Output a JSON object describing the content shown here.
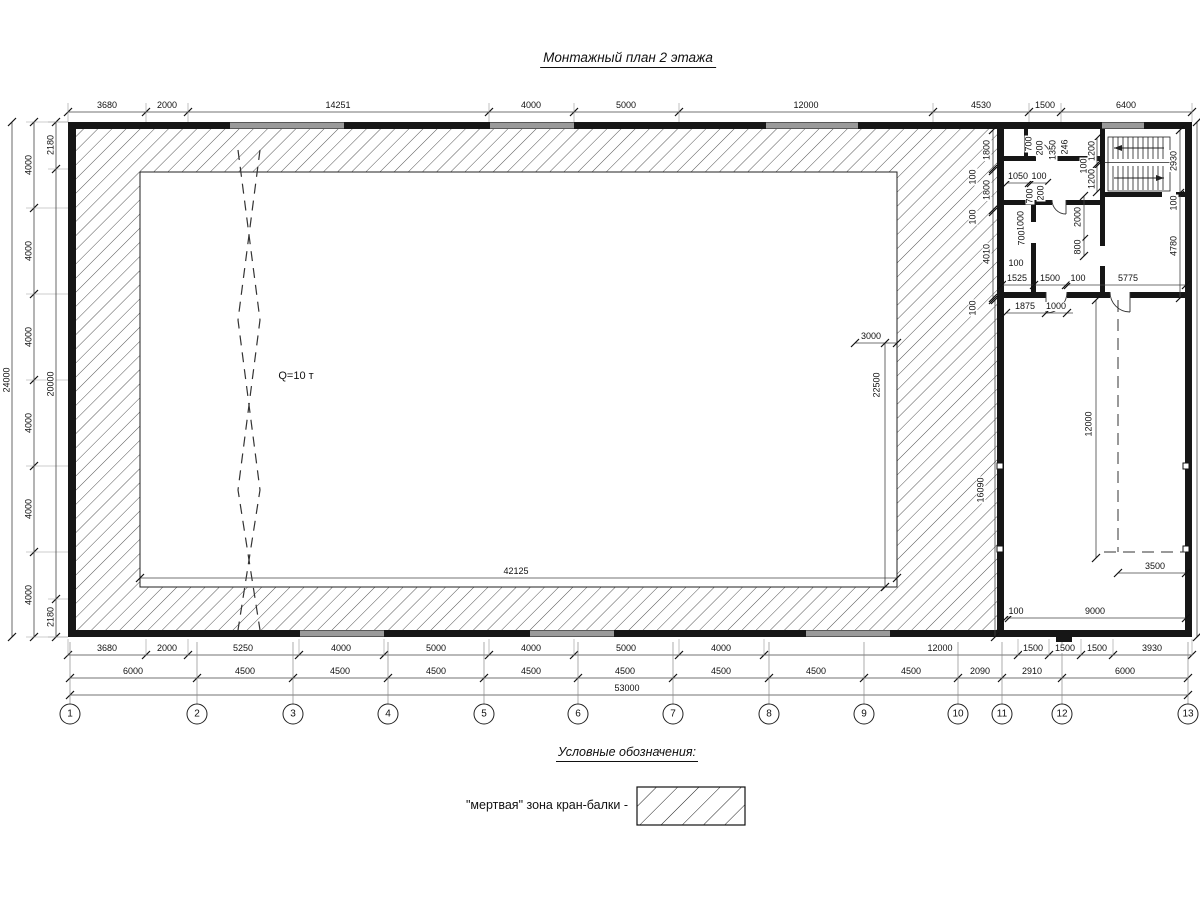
{
  "title": "Монтажный план 2 этажа",
  "crane_label": "Q=10 т",
  "legend": {
    "heading": "Условные обозначения:",
    "item_label": "\"мертвая\" зона кран-балки -"
  },
  "axis_row": {
    "y": 714,
    "items": [
      {
        "n": "1",
        "x": 70
      },
      {
        "n": "2",
        "x": 197
      },
      {
        "n": "3",
        "x": 293
      },
      {
        "n": "4",
        "x": 388
      },
      {
        "n": "5",
        "x": 484
      },
      {
        "n": "6",
        "x": 578
      },
      {
        "n": "7",
        "x": 673
      },
      {
        "n": "8",
        "x": 769
      },
      {
        "n": "9",
        "x": 864
      },
      {
        "n": "10",
        "x": 958
      },
      {
        "n": "11",
        "x": 1002
      },
      {
        "n": "12",
        "x": 1062
      },
      {
        "n": "13",
        "x": 1188
      }
    ]
  },
  "dim_rows": [
    {
      "o": "h",
      "y": 112,
      "x0": 68,
      "x1": 1192,
      "ext": [
        103,
        122
      ],
      "ticks": [
        68,
        146,
        188,
        489,
        574,
        679,
        933,
        1029,
        1061,
        1192
      ],
      "labels": [
        {
          "t": "3680",
          "x": 107
        },
        {
          "t": "2000",
          "x": 167
        },
        {
          "t": "14251",
          "x": 338
        },
        {
          "t": "4000",
          "x": 531
        },
        {
          "t": "5000",
          "x": 626
        },
        {
          "t": "12000",
          "x": 806
        },
        {
          "t": "4530",
          "x": 981
        },
        {
          "t": "1500",
          "x": 1045
        },
        {
          "t": "6400",
          "x": 1126
        }
      ]
    },
    {
      "o": "h",
      "y": 655,
      "x0": 68,
      "x1": 1192,
      "ext": [
        639,
        656
      ],
      "ticks": [
        68,
        146,
        188,
        299,
        384,
        489,
        574,
        679,
        764,
        1018,
        1049,
        1081,
        1113,
        1192
      ],
      "labels": [
        {
          "t": "3680",
          "x": 107
        },
        {
          "t": "2000",
          "x": 167
        },
        {
          "t": "5250",
          "x": 243
        },
        {
          "t": "4000",
          "x": 341
        },
        {
          "t": "5000",
          "x": 436
        },
        {
          "t": "4000",
          "x": 531
        },
        {
          "t": "5000",
          "x": 626
        },
        {
          "t": "4000",
          "x": 721
        },
        {
          "t": "12000",
          "x": 940
        },
        {
          "t": "1500",
          "x": 1033
        },
        {
          "t": "1500",
          "x": 1065
        },
        {
          "t": "1500",
          "x": 1097
        },
        {
          "t": "3930",
          "x": 1152
        }
      ]
    },
    {
      "o": "h",
      "y": 678,
      "x0": 70,
      "x1": 1188,
      "ticks": [
        70,
        197,
        293,
        388,
        484,
        578,
        673,
        769,
        864,
        958,
        1002,
        1062,
        1188
      ],
      "labels": [
        {
          "t": "6000",
          "x": 133
        },
        {
          "t": "4500",
          "x": 245
        },
        {
          "t": "4500",
          "x": 340
        },
        {
          "t": "4500",
          "x": 436
        },
        {
          "t": "4500",
          "x": 531
        },
        {
          "t": "4500",
          "x": 625
        },
        {
          "t": "4500",
          "x": 721
        },
        {
          "t": "4500",
          "x": 816
        },
        {
          "t": "4500",
          "x": 911
        },
        {
          "t": "2090",
          "x": 980
        },
        {
          "t": "2910",
          "x": 1032
        },
        {
          "t": "6000",
          "x": 1125
        }
      ]
    },
    {
      "o": "h",
      "y": 695,
      "x0": 70,
      "x1": 1188,
      "ticks": [
        70,
        1188
      ],
      "labels": [
        {
          "t": "53000",
          "x": 627
        }
      ]
    },
    {
      "o": "h",
      "y": 578,
      "x0": 140,
      "x1": 897,
      "ticks": [
        140,
        897
      ],
      "labels": [
        {
          "t": "42125",
          "x": 516
        }
      ]
    },
    {
      "o": "h",
      "y": 343,
      "x0": 855,
      "x1": 897,
      "ticks": [
        855,
        897
      ],
      "labels": [
        {
          "t": "3000",
          "x": 871
        }
      ]
    },
    {
      "o": "h",
      "y": 285,
      "x0": 1002,
      "x1": 1186,
      "ticks": [
        1002,
        1034,
        1066,
        1068,
        1186
      ],
      "labels": [
        {
          "t": "1525",
          "x": 1017
        },
        {
          "t": "1500",
          "x": 1050
        },
        {
          "t": "100",
          "x": 1078
        },
        {
          "t": "5775",
          "x": 1128
        }
      ]
    },
    {
      "o": "h",
      "y": 313,
      "x0": 1006,
      "x1": 1073,
      "ticks": [
        1006,
        1046,
        1067
      ],
      "labels": [
        {
          "t": "1875",
          "x": 1025
        },
        {
          "t": "1000",
          "x": 1056
        }
      ]
    },
    {
      "o": "h",
      "y": 183,
      "x0": 1007,
      "x1": 1047,
      "ticks": [
        1007,
        1029,
        1031,
        1047
      ],
      "labels": [
        {
          "t": "1050",
          "x": 1018
        },
        {
          "t": "100",
          "x": 1039
        }
      ]
    },
    {
      "o": "h",
      "y": 573,
      "x0": 1118,
      "x1": 1186,
      "ticks": [
        1118,
        1186
      ],
      "labels": [
        {
          "t": "3500",
          "x": 1155
        }
      ]
    },
    {
      "o": "h",
      "y": 618,
      "x0": 1006,
      "x1": 1186,
      "ticks": [
        1006,
        1009,
        1186
      ],
      "labels": [
        {
          "t": "100",
          "x": 1016
        },
        {
          "t": "9000",
          "x": 1095
        }
      ]
    },
    {
      "o": "v",
      "x": 12,
      "y0": 122,
      "y1": 637,
      "ticks": [
        122,
        637
      ],
      "labels": [
        {
          "t": "24000",
          "y": 380,
          "dx": -5
        }
      ]
    },
    {
      "o": "v",
      "x": 34,
      "y0": 122,
      "y1": 637,
      "ext": [
        26,
        68
      ],
      "ticks": [
        122,
        208,
        294,
        380,
        466,
        552,
        637
      ],
      "labels": [
        {
          "t": "4000",
          "y": 165,
          "dx": -5
        },
        {
          "t": "4000",
          "y": 251,
          "dx": -5
        },
        {
          "t": "4000",
          "y": 337,
          "dx": -5
        },
        {
          "t": "4000",
          "y": 423,
          "dx": -5
        },
        {
          "t": "4000",
          "y": 509,
          "dx": -5
        },
        {
          "t": "4000",
          "y": 595,
          "dx": -5
        }
      ]
    },
    {
      "o": "v",
      "x": 56,
      "y0": 122,
      "y1": 637,
      "ext": [
        48,
        68
      ],
      "ticks": [
        122,
        169,
        599,
        637
      ],
      "labels": [
        {
          "t": "2180",
          "y": 145,
          "dx": -5
        },
        {
          "t": "20000",
          "y": 384,
          "dx": -5
        },
        {
          "t": "2180",
          "y": 617,
          "dx": -5
        }
      ]
    },
    {
      "o": "v",
      "x": 885,
      "y0": 343,
      "y1": 587,
      "ticks": [
        343,
        587
      ],
      "labels": [
        {
          "t": "22500",
          "y": 385,
          "dx": -8
        }
      ]
    },
    {
      "o": "v",
      "x": 993,
      "y0": 130,
      "y1": 300,
      "ticks": [
        130,
        169,
        171,
        210,
        212,
        298,
        300
      ],
      "labels": [
        {
          "t": "1800",
          "y": 150,
          "dx": -6
        },
        {
          "t": "100",
          "y": 177,
          "dx": -20
        },
        {
          "t": "1800",
          "y": 190,
          "dx": -6
        },
        {
          "t": "100",
          "y": 217,
          "dx": -20
        },
        {
          "t": "4010",
          "y": 254,
          "dx": -6
        },
        {
          "t": "100",
          "y": 308,
          "dx": -20
        }
      ]
    },
    {
      "o": "v",
      "x": 1084,
      "y0": 196,
      "y1": 256,
      "ticks": [
        196,
        239,
        256
      ],
      "labels": [
        {
          "t": "2000",
          "y": 217,
          "dx": -6
        },
        {
          "t": "800",
          "y": 247,
          "dx": -6
        }
      ]
    },
    {
      "o": "v",
      "x": 1097,
      "y0": 138,
      "y1": 192,
      "ticks": [
        138,
        164,
        166,
        192
      ],
      "labels": [
        {
          "t": "1200",
          "y": 151,
          "dx": -5
        },
        {
          "t": "100",
          "y": 166,
          "dx": -13
        },
        {
          "t": "1200",
          "y": 179,
          "dx": -5
        }
      ]
    },
    {
      "o": "v",
      "x": 1180,
      "y0": 130,
      "y1": 298,
      "ticks": [
        130,
        193,
        195,
        298
      ],
      "labels": [
        {
          "t": "2930",
          "y": 161,
          "dx": -6
        },
        {
          "t": "100",
          "y": 203,
          "dx": -6
        },
        {
          "t": "4780",
          "y": 246,
          "dx": -6
        }
      ]
    },
    {
      "o": "v",
      "x": 995,
      "y0": 300,
      "y1": 637,
      "ticks": [
        300,
        637
      ],
      "labels": [
        {
          "t": "16090",
          "y": 490,
          "dx": -14
        }
      ]
    },
    {
      "o": "v",
      "x": 1096,
      "y0": 300,
      "y1": 558,
      "ticks": [
        300,
        558
      ],
      "labels": [
        {
          "t": "12000",
          "y": 424,
          "dx": -7
        }
      ]
    },
    {
      "o": "v",
      "x": 1197,
      "y0": 122,
      "y1": 637,
      "ticks": [
        122,
        637
      ],
      "labels": []
    }
  ],
  "free_labels": [
    {
      "t": "700",
      "x": 1029,
      "y": 144,
      "r": -90
    },
    {
      "t": "200",
      "x": 1040,
      "y": 148,
      "r": -90
    },
    {
      "t": "1350",
      "x": 1053,
      "y": 150,
      "r": -90
    },
    {
      "t": "246",
      "x": 1065,
      "y": 147,
      "r": -90
    },
    {
      "t": "700",
      "x": 1030,
      "y": 196,
      "r": -90
    },
    {
      "t": "200",
      "x": 1041,
      "y": 193,
      "r": -90
    },
    {
      "t": "1000",
      "x": 1021,
      "y": 221,
      "r": -90
    },
    {
      "t": "700",
      "x": 1022,
      "y": 238,
      "r": -90
    },
    {
      "t": "100",
      "x": 1016,
      "y": 268,
      "r": 0
    },
    {
      "t": "Q=10 т",
      "x": 296,
      "y": 382,
      "r": 0,
      "cls": "big",
      "name": "crane-capacity-label"
    }
  ]
}
